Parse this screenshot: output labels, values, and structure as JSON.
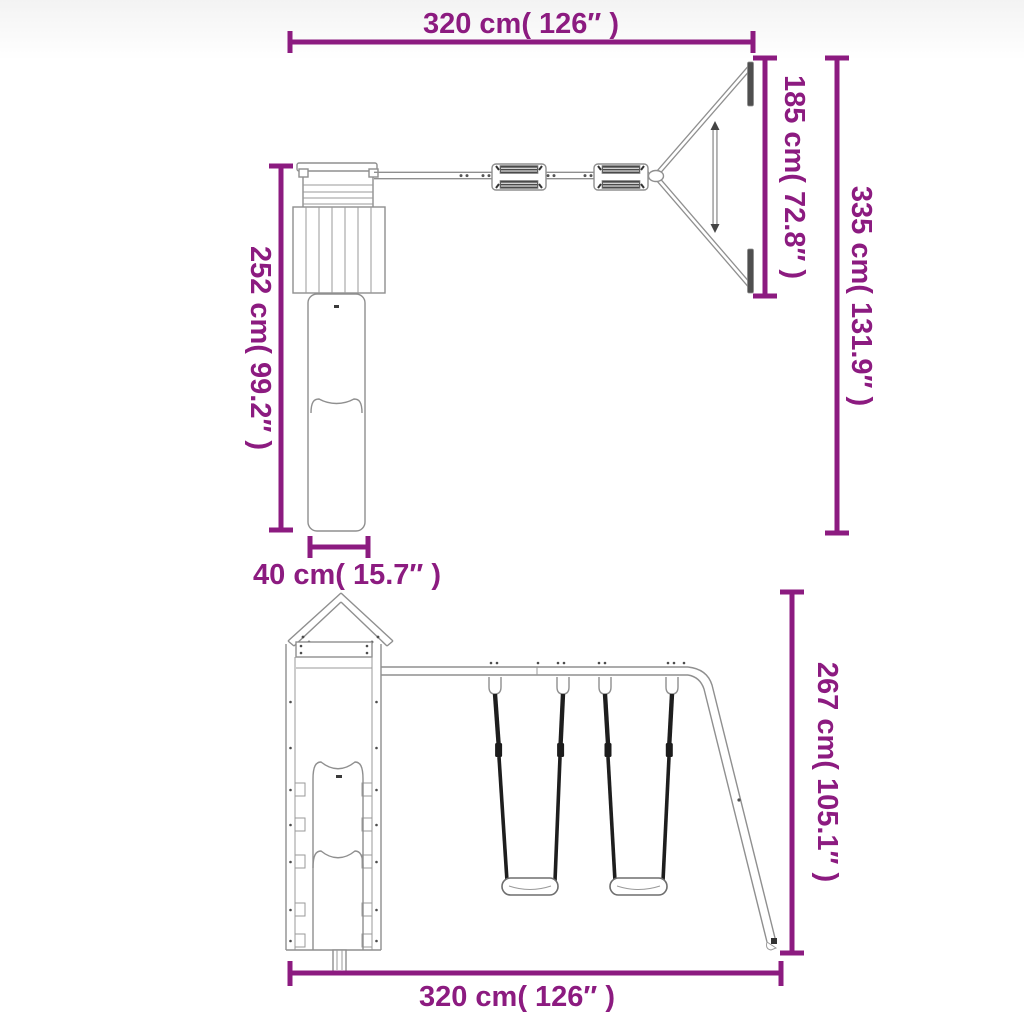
{
  "diagram": {
    "type": "product-dimension-diagram",
    "subject": "playhouse-with-slide-and-double-swing-set",
    "colors": {
      "dimension_accent": "#8c1b80",
      "drawing_outline": "#8f8f8f",
      "drawing_dark": "#2b2b2b",
      "background": "#ffffff"
    },
    "views": {
      "top_view": {
        "dimensions": {
          "top_width": {
            "label": "320 cm( 126″ )",
            "value_cm": 320,
            "value_in": 126
          },
          "aframe_depth": {
            "label": "185 cm( 72.8″ )",
            "value_cm": 185,
            "value_in": 72.8
          },
          "total_depth": {
            "label": "335 cm( 131.9″ )",
            "value_cm": 335,
            "value_in": 131.9
          },
          "tower_depth": {
            "label": "252 cm( 99.2″ )",
            "value_cm": 252,
            "value_in": 99.2
          },
          "slide_width": {
            "label": "40 cm( 15.7″ )",
            "value_cm": 40,
            "value_in": 15.7
          }
        }
      },
      "front_view": {
        "dimensions": {
          "overall_height": {
            "label": "267 cm( 105.1″ )",
            "value_cm": 267,
            "value_in": 105.1
          },
          "bottom_width": {
            "label": "320 cm( 126″ )",
            "value_cm": 320,
            "value_in": 126
          }
        }
      }
    }
  }
}
